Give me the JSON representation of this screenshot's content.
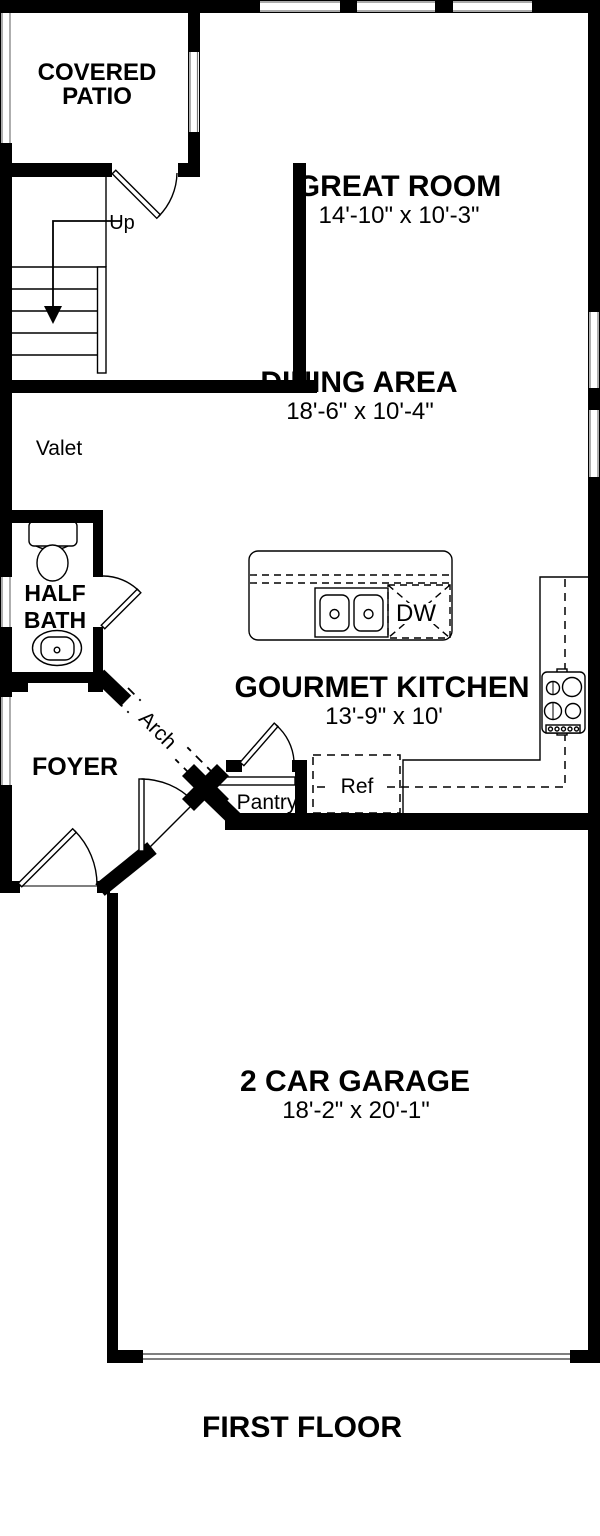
{
  "colors": {
    "wall": "#000000",
    "background": "#ffffff",
    "line": "#000000"
  },
  "footer": {
    "title": "FIRST FLOOR"
  },
  "rooms": {
    "covered_patio": {
      "line1": "COVERED",
      "line2": "PATIO"
    },
    "great_room": {
      "name": "GREAT ROOM",
      "dims": "14'-10\" x 10'-3\""
    },
    "dining_area": {
      "name": "DINING AREA",
      "dims": "18'-6\" x 10'-4\""
    },
    "gourmet_kitchen": {
      "name": "GOURMET KITCHEN",
      "dims": "13'-9\" x 10'"
    },
    "half_bath": {
      "line1": "HALF",
      "line2": "BATH"
    },
    "foyer": {
      "name": "FOYER"
    },
    "garage": {
      "name": "2 CAR GARAGE",
      "dims": "18'-2\" x 20'-1\""
    }
  },
  "labels": {
    "up": "Up",
    "valet": "Valet",
    "arch": "Arch",
    "pantry": "Pantry",
    "ref": "Ref",
    "dishwasher": "DW"
  }
}
